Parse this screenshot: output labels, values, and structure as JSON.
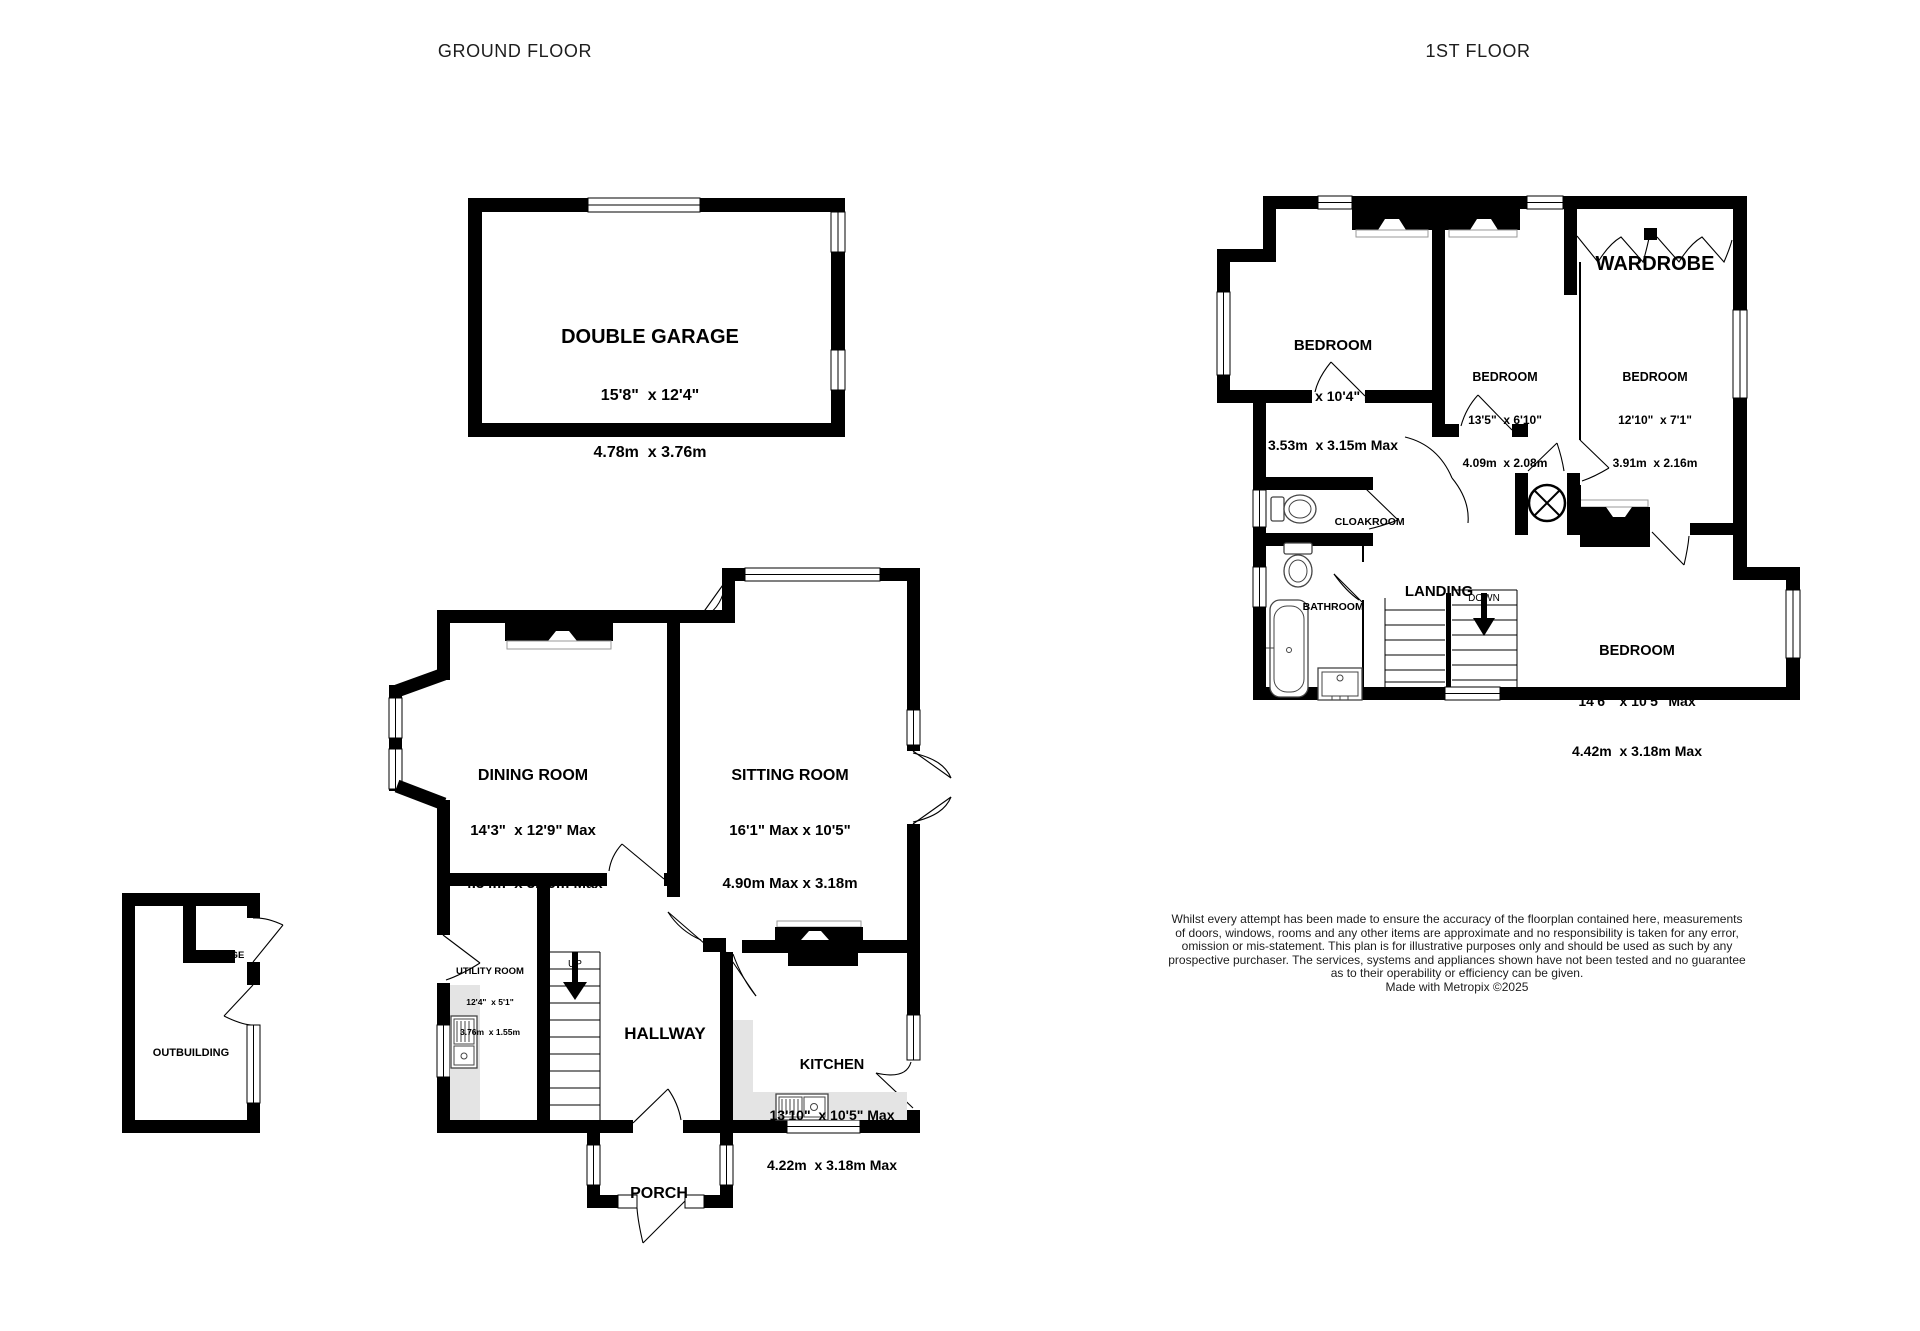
{
  "titles": {
    "ground_floor": "GROUND FLOOR",
    "first_floor": "1ST FLOOR"
  },
  "ground_floor": {
    "garage": {
      "name": "DOUBLE GARAGE",
      "imperial": "15'8\"  x 12'4\"",
      "metric": "4.78m  x 3.76m"
    },
    "dining_room": {
      "name": "DINING ROOM",
      "imperial": "14'3\"  x 12'9\" Max",
      "metric": "4.34m  x 3.89m Max"
    },
    "sitting_room": {
      "name": "SITTING ROOM",
      "imperial": "16'1\" Max x 10'5\"",
      "metric": "4.90m Max x 3.18m"
    },
    "kitchen": {
      "name": "KITCHEN",
      "imperial": "13'10\"  x 10'5\" Max",
      "metric": "4.22m  x 3.18m Max"
    },
    "utility_room": {
      "name": "UTILITY ROOM",
      "imperial": "12'4\"  x 5'1\"",
      "metric": "3.76m  x 1.55m"
    },
    "hallway": {
      "name": "HALLWAY"
    },
    "porch": {
      "name": "PORCH"
    },
    "outbuilding": {
      "name": "OUTBUILDING"
    },
    "storage": {
      "name": "STORAGE"
    },
    "stairs_label": "UP"
  },
  "first_floor": {
    "bedroom_1": {
      "name": "BEDROOM",
      "imperial": "11'7\"  x 10'4\" Max",
      "metric": "3.53m  x 3.15m Max"
    },
    "bedroom_2": {
      "name": "BEDROOM",
      "imperial": "13'5\"  x 6'10\"",
      "metric": "4.09m  x 2.08m"
    },
    "bedroom_3": {
      "name": "BEDROOM",
      "imperial": "12'10\"  x 7'1\"",
      "metric": "3.91m  x 2.16m"
    },
    "bedroom_4": {
      "name": "BEDROOM",
      "imperial": "14'6\"  x 10'5\" Max",
      "metric": "4.42m  x 3.18m Max"
    },
    "wardrobe": {
      "name": "WARDROBE"
    },
    "landing": {
      "name": "LANDING"
    },
    "cloakroom": {
      "name": "CLOAKROOM"
    },
    "bathroom": {
      "name": "BATHROOM"
    },
    "stairs_label": "DOWN"
  },
  "disclaimer": {
    "line1": "Whilst every attempt has been made to ensure the accuracy of the floorplan contained here, measurements",
    "line2": "of doors, windows, rooms and any other items are approximate and no responsibility is taken for any error,",
    "line3": "omission or mis-statement. This plan is for illustrative purposes only and should be used as such by any",
    "line4": "prospective purchaser. The services, systems and appliances shown have not been tested and no guarantee",
    "line5": "as to their operability or efficiency can be given.",
    "line6": "Made with Metropix ©2025"
  },
  "colors": {
    "wall": "#000000",
    "counter": "#e4e4e4",
    "background": "#ffffff"
  }
}
